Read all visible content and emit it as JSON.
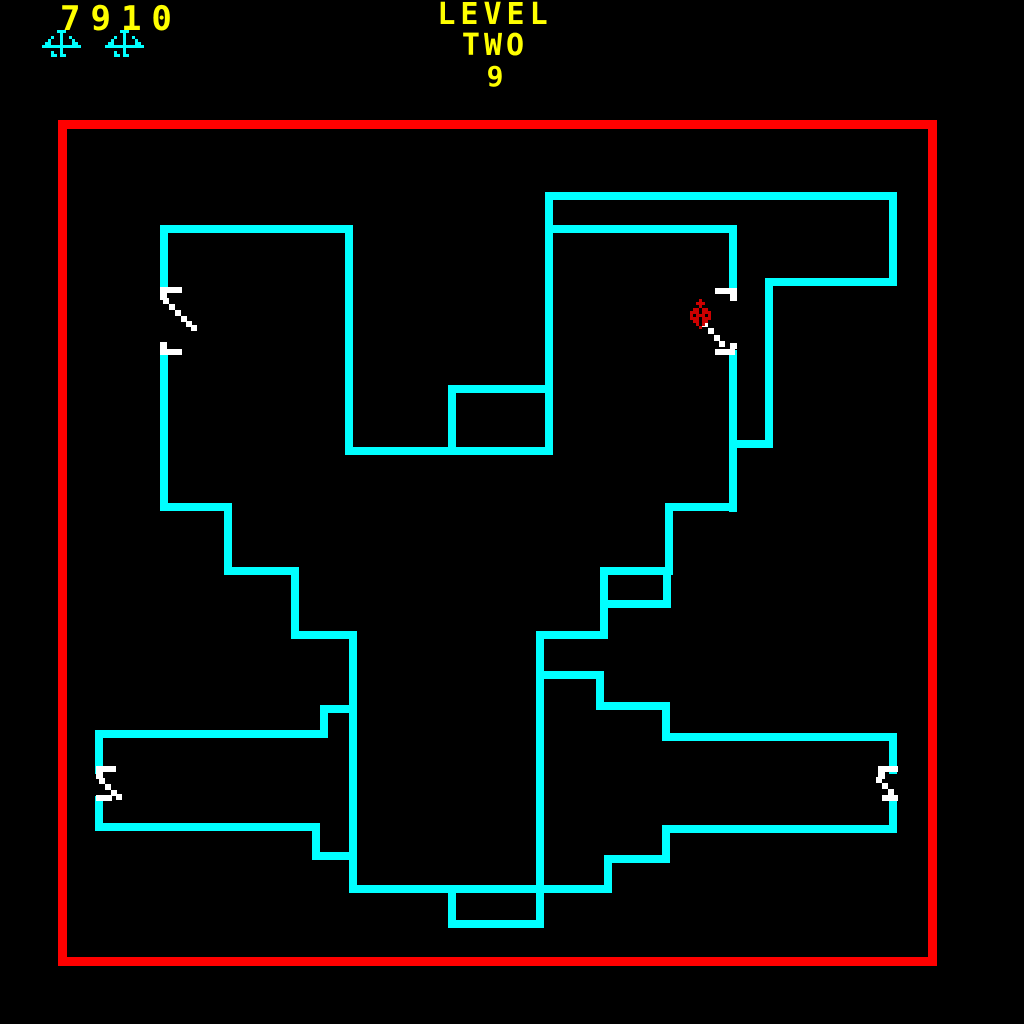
{
  "hud": {
    "score": "7910",
    "lives_count": 2,
    "level_line1": "LEVEL",
    "level_line2": "TWO",
    "level_line3": "9"
  },
  "colors": {
    "background": "#000000",
    "wall": "#00FFFF",
    "border": "#FF0000",
    "hud_text": "#FFFF00",
    "door": "#FFFFFF",
    "enemy": "#CC0000",
    "life_icon": "#00FFFF"
  },
  "playfield": {
    "border_rect": [
      58,
      120,
      879,
      846
    ],
    "border_thickness": 9
  },
  "maze": {
    "walls": [
      [
        160,
        225,
        193,
        8
      ],
      [
        160,
        225,
        8,
        67
      ],
      [
        160,
        350,
        8,
        161
      ],
      [
        160,
        503,
        72,
        8
      ],
      [
        224,
        503,
        8,
        72
      ],
      [
        224,
        567,
        75,
        8
      ],
      [
        291,
        567,
        8,
        72
      ],
      [
        291,
        631,
        66,
        8
      ],
      [
        349,
        631,
        8,
        262
      ],
      [
        320,
        705,
        37,
        8
      ],
      [
        320,
        705,
        8,
        33
      ],
      [
        95,
        730,
        233,
        8
      ],
      [
        95,
        730,
        8,
        44
      ],
      [
        95,
        796,
        8,
        35
      ],
      [
        95,
        823,
        225,
        8
      ],
      [
        312,
        823,
        8,
        37
      ],
      [
        312,
        852,
        45,
        8
      ],
      [
        349,
        885,
        263,
        8
      ],
      [
        448,
        885,
        8,
        43
      ],
      [
        448,
        920,
        95,
        8
      ],
      [
        536,
        631,
        8,
        297
      ],
      [
        536,
        631,
        72,
        8
      ],
      [
        544,
        671,
        60,
        8
      ],
      [
        596,
        671,
        8,
        39
      ],
      [
        604,
        702,
        66,
        8
      ],
      [
        662,
        702,
        8,
        39
      ],
      [
        662,
        733,
        235,
        8
      ],
      [
        889,
        733,
        8,
        41
      ],
      [
        889,
        796,
        8,
        37
      ],
      [
        670,
        825,
        227,
        8
      ],
      [
        662,
        825,
        8,
        38
      ],
      [
        608,
        855,
        62,
        8
      ],
      [
        604,
        855,
        8,
        38
      ],
      [
        345,
        225,
        8,
        230
      ],
      [
        345,
        447,
        208,
        8
      ],
      [
        448,
        385,
        97,
        8
      ],
      [
        448,
        385,
        8,
        70
      ],
      [
        545,
        192,
        8,
        263
      ],
      [
        553,
        192,
        344,
        8
      ],
      [
        553,
        225,
        184,
        8
      ],
      [
        889,
        192,
        8,
        94
      ],
      [
        770,
        278,
        127,
        8
      ],
      [
        765,
        278,
        8,
        170
      ],
      [
        729,
        440,
        44,
        8
      ],
      [
        729,
        225,
        8,
        67
      ],
      [
        729,
        350,
        8,
        162
      ],
      [
        665,
        503,
        72,
        8
      ],
      [
        665,
        503,
        8,
        72
      ],
      [
        600,
        567,
        72,
        8
      ],
      [
        600,
        567,
        8,
        72
      ],
      [
        663,
        567,
        8,
        40
      ],
      [
        608,
        600,
        63,
        8
      ]
    ],
    "doors": [
      {
        "name": "door-left-upper",
        "brackets": [
          [
            160,
            287,
            22,
            6
          ],
          [
            160,
            293,
            7,
            7
          ],
          [
            160,
            342,
            7,
            7
          ],
          [
            160,
            349,
            22,
            6
          ]
        ],
        "dashes": [
          [
            163,
            298
          ],
          [
            169,
            304
          ],
          [
            175,
            310
          ],
          [
            181,
            316
          ],
          [
            186,
            321
          ],
          [
            191,
            325
          ]
        ]
      },
      {
        "name": "door-right-upper",
        "brackets": [
          [
            715,
            288,
            22,
            6
          ],
          [
            730,
            294,
            7,
            7
          ],
          [
            730,
            343,
            7,
            6
          ],
          [
            715,
            349,
            20,
            6
          ]
        ],
        "dashes": [
          [
            702,
            321
          ],
          [
            708,
            328
          ],
          [
            714,
            335
          ],
          [
            719,
            341
          ]
        ]
      },
      {
        "name": "door-left-corridor",
        "brackets": [
          [
            96,
            766,
            20,
            6
          ],
          [
            96,
            772,
            7,
            7
          ],
          [
            96,
            795,
            16,
            6
          ]
        ],
        "dashes": [
          [
            99,
            778
          ],
          [
            105,
            784
          ],
          [
            111,
            790
          ],
          [
            116,
            794
          ]
        ]
      },
      {
        "name": "door-right-corridor",
        "brackets": [
          [
            878,
            766,
            20,
            6
          ],
          [
            878,
            772,
            7,
            7
          ],
          [
            882,
            795,
            16,
            6
          ]
        ],
        "dashes": [
          [
            876,
            777
          ],
          [
            882,
            783
          ],
          [
            888,
            789
          ]
        ]
      }
    ]
  },
  "sprites": {
    "enemy": {
      "x": 690,
      "y": 299,
      "pixel": 3,
      "rows": [
        "...R...",
        "..RRR..",
        "...R...",
        ".RR.RR.",
        "RRR.RRR",
        "R.RRR.R",
        "RRR.RRR",
        ".RR.RR.",
        "..R.R..",
        "...R..."
      ]
    },
    "life_icon": {
      "pixel": 3,
      "rows": [
        ".....CCC.....",
        "......C......",
        "...C..C..C...",
        "..C...C...C..",
        ".CC...C...CC.",
        "CCCCCCCCCCCCC",
        "......C......",
        "...C..C......",
        "...CC.CC....."
      ]
    }
  }
}
